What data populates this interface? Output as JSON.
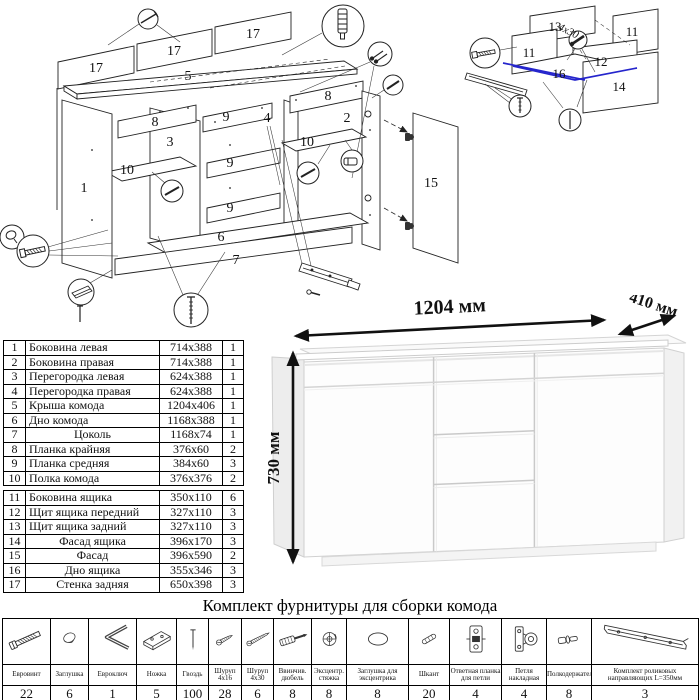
{
  "colors": {
    "highlight_blue": "#2525cc",
    "ink": "#1a1a1a"
  },
  "main_diagram": {
    "labels": {
      "p17a": "17",
      "p17b": "17",
      "p17c": "17",
      "p5": "5",
      "p8l": "8",
      "p8r": "8",
      "p9a": "9",
      "p9b": "9",
      "p9c": "9",
      "p1": "1",
      "p2": "2",
      "p3": "3",
      "p4": "4",
      "p6": "6",
      "p7": "7",
      "p10l": "10",
      "p10r": "10",
      "p15": "15"
    }
  },
  "drawer_diagram": {
    "labels": {
      "d11l": "11",
      "d11r": "11",
      "d12": "12",
      "d13": "13",
      "d14": "14",
      "d16": "16",
      "screw_note": "4x30"
    }
  },
  "dimension_drawing": {
    "width_label": "1204 мм",
    "depth_label": "410 мм",
    "height_label": "730 мм"
  },
  "parts_table": {
    "rows": [
      {
        "num": "1",
        "name": "Боковина левая",
        "size": "714x388",
        "qty": "1"
      },
      {
        "num": "2",
        "name": "Боковина правая",
        "size": "714x388",
        "qty": "1"
      },
      {
        "num": "3",
        "name": "Перегородка левая",
        "size": "624x388",
        "qty": "1"
      },
      {
        "num": "4",
        "name": "Перегородка правая",
        "size": "624x388",
        "qty": "1"
      },
      {
        "num": "5",
        "name": "Крыша комода",
        "size": "1204x406",
        "qty": "1"
      },
      {
        "num": "6",
        "name": "Дно комода",
        "size": "1168x388",
        "qty": "1"
      },
      {
        "num": "7",
        "name": "Цоколь",
        "size": "1168x74",
        "qty": "1"
      },
      {
        "num": "8",
        "name": "Планка крайняя",
        "size": "376x60",
        "qty": "2"
      },
      {
        "num": "9",
        "name": "Планка средняя",
        "size": "384x60",
        "qty": "3"
      },
      {
        "num": "10",
        "name": "Полка комода",
        "size": "376x376",
        "qty": "2"
      },
      {
        "num": "11",
        "name": "Боковина ящика",
        "size": "350x110",
        "qty": "6"
      },
      {
        "num": "12",
        "name": "Щит ящика передний",
        "size": "327x110",
        "qty": "3"
      },
      {
        "num": "13",
        "name": "Щит ящика задний",
        "size": "327x110",
        "qty": "3"
      },
      {
        "num": "14",
        "name": "Фасад ящика",
        "size": "396x170",
        "qty": "3"
      },
      {
        "num": "15",
        "name": "Фасад",
        "size": "396x590",
        "qty": "2"
      },
      {
        "num": "16",
        "name": "Дно ящика",
        "size": "355x346",
        "qty": "3"
      },
      {
        "num": "17",
        "name": "Стенка задняя",
        "size": "650x398",
        "qty": "3"
      }
    ]
  },
  "hardware": {
    "title": "Комплект фурнитуры для сборки комода",
    "items": [
      {
        "name": "Евровинт",
        "qty": "22",
        "icon": "euro-screw-icon"
      },
      {
        "name": "Заглушка",
        "qty": "6",
        "icon": "plug-icon"
      },
      {
        "name": "Евроключ",
        "qty": "1",
        "icon": "hex-key-icon"
      },
      {
        "name": "Ножка",
        "qty": "5",
        "icon": "leg-icon"
      },
      {
        "name": "Гвоздь",
        "qty": "100",
        "icon": "nail-icon"
      },
      {
        "name": "Шуруп 4x16",
        "qty": "28",
        "icon": "screw-4x16-icon"
      },
      {
        "name": "Шуруп 4x30",
        "qty": "6",
        "icon": "screw-4x30-icon"
      },
      {
        "name": "Ввинчив. дюбель",
        "qty": "8",
        "icon": "screw-in-dowel-icon"
      },
      {
        "name": "Эксцентр. стяжка",
        "qty": "8",
        "icon": "cam-lock-icon"
      },
      {
        "name": "Заглушка для эксцентрика",
        "qty": "8",
        "icon": "cam-cap-icon"
      },
      {
        "name": "Шкант",
        "qty": "20",
        "icon": "dowel-icon"
      },
      {
        "name": "Ответная планка для петли",
        "qty": "4",
        "icon": "hinge-plate-icon"
      },
      {
        "name": "Петля накладная",
        "qty": "4",
        "icon": "hinge-icon"
      },
      {
        "name": "Полкодержатель",
        "qty": "8",
        "icon": "shelf-pin-icon"
      },
      {
        "name": "Комплект роликовых направляющих L=350мм",
        "qty": "3",
        "icon": "roller-guide-icon"
      }
    ]
  }
}
